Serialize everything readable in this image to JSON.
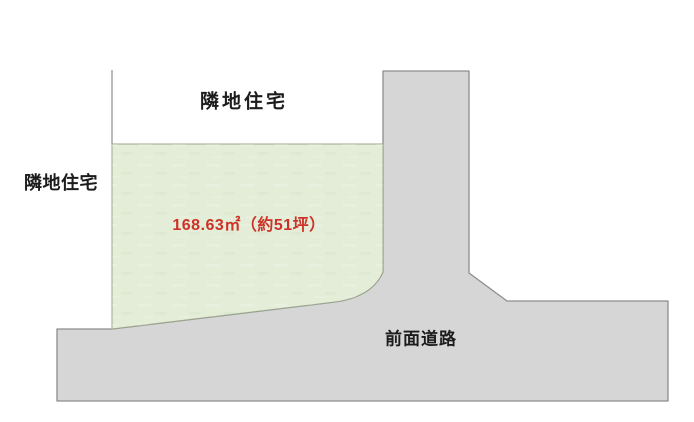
{
  "diagram": {
    "title": "land-plot-diagram",
    "labels": {
      "neighbor_top": "隣地住宅",
      "neighbor_left": "隣地住宅",
      "area": "168.63㎡（約51坪）",
      "road": "前面道路"
    },
    "colors": {
      "parcel_fill": "#e3edd8",
      "parcel_border": "#9aa68d",
      "road_fill": "#d6d6d6",
      "road_border": "#8d8d8d",
      "area_text": "#cc3227",
      "label_text": "#1c1c1c",
      "background": "#ffffff"
    }
  }
}
